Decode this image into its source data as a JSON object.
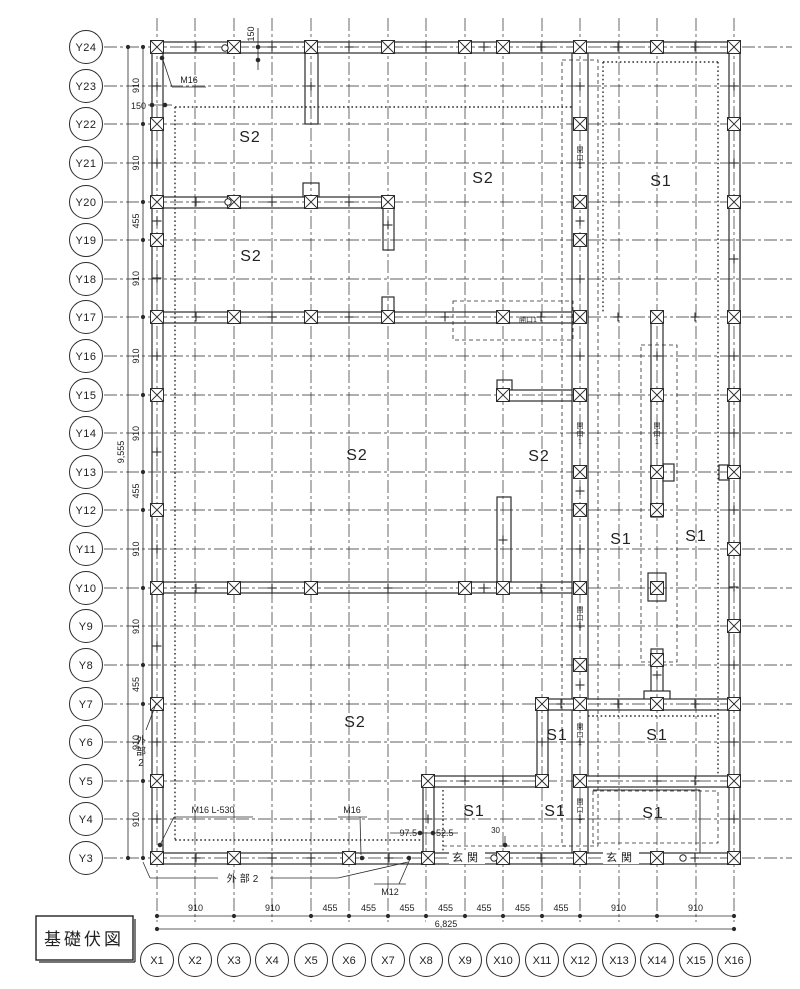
{
  "title_box": {
    "label": "基礎伏図"
  },
  "line_color": "#2b2b2b",
  "grid": {
    "x_axes": [
      {
        "label": "X1",
        "x": 157
      },
      {
        "label": "X2",
        "x": 195
      },
      {
        "label": "X3",
        "x": 234
      },
      {
        "label": "X4",
        "x": 272
      },
      {
        "label": "X5",
        "x": 311
      },
      {
        "label": "X6",
        "x": 349
      },
      {
        "label": "X7",
        "x": 388
      },
      {
        "label": "X8",
        "x": 426
      },
      {
        "label": "X9",
        "x": 465
      },
      {
        "label": "X10",
        "x": 503
      },
      {
        "label": "X11",
        "x": 542
      },
      {
        "label": "X12",
        "x": 580
      },
      {
        "label": "X13",
        "x": 619
      },
      {
        "label": "X14",
        "x": 657
      },
      {
        "label": "X15",
        "x": 696
      },
      {
        "label": "X16",
        "x": 734
      }
    ],
    "y_axes": [
      {
        "label": "Y24",
        "y": 47
      },
      {
        "label": "Y23",
        "y": 86
      },
      {
        "label": "Y22",
        "y": 124
      },
      {
        "label": "Y21",
        "y": 163
      },
      {
        "label": "Y20",
        "y": 202
      },
      {
        "label": "Y19",
        "y": 240
      },
      {
        "label": "Y18",
        "y": 279
      },
      {
        "label": "Y17",
        "y": 317
      },
      {
        "label": "Y16",
        "y": 356
      },
      {
        "label": "Y15",
        "y": 395
      },
      {
        "label": "Y14",
        "y": 433
      },
      {
        "label": "Y13",
        "y": 472
      },
      {
        "label": "Y12",
        "y": 510
      },
      {
        "label": "Y11",
        "y": 549
      },
      {
        "label": "Y10",
        "y": 588
      },
      {
        "label": "Y9",
        "y": 626
      },
      {
        "label": "Y8",
        "y": 665
      },
      {
        "label": "Y7",
        "y": 704
      },
      {
        "label": "Y6",
        "y": 742
      },
      {
        "label": "Y5",
        "y": 781
      },
      {
        "label": "Y4",
        "y": 819
      },
      {
        "label": "Y3",
        "y": 858
      }
    ]
  },
  "dim_left": {
    "total": "9,555",
    "boundaries": [
      47,
      124,
      202,
      240,
      317,
      395,
      472,
      510,
      588,
      665,
      704,
      781,
      858
    ],
    "labels": [
      "910",
      "910",
      "455",
      "910",
      "910",
      "910",
      "455",
      "910",
      "910",
      "455",
      "910",
      "910"
    ]
  },
  "dim_bottom": {
    "total": "6,825",
    "boundaries": [
      157,
      234,
      311,
      349,
      388,
      426,
      465,
      503,
      542,
      580,
      657,
      734
    ],
    "labels": [
      "910",
      "910",
      "455",
      "455",
      "455",
      "455",
      "455",
      "455",
      "455",
      "910",
      "910"
    ]
  },
  "walls": [
    [
      152,
      42,
      588,
      11
    ],
    [
      152,
      42,
      11,
      821
    ],
    [
      152,
      853,
      588,
      11
    ],
    [
      729,
      42,
      11,
      821
    ],
    [
      305,
      53,
      13,
      71
    ],
    [
      303,
      183,
      16,
      15
    ],
    [
      163,
      197,
      231,
      11
    ],
    [
      383,
      208,
      11,
      42
    ],
    [
      382,
      297,
      12,
      16
    ],
    [
      163,
      312,
      425,
      11
    ],
    [
      572,
      53,
      16,
      800
    ],
    [
      497,
      380,
      15,
      11
    ],
    [
      497,
      390,
      75,
      11
    ],
    [
      497,
      497,
      14,
      91
    ],
    [
      163,
      582,
      409,
      11
    ],
    [
      651,
      317,
      12,
      200
    ],
    [
      663,
      464,
      11,
      17
    ],
    [
      719,
      465,
      10,
      15
    ],
    [
      648,
      573,
      18,
      28
    ],
    [
      651,
      649,
      12,
      45
    ],
    [
      644,
      691,
      26,
      12
    ],
    [
      537,
      699,
      203,
      11
    ],
    [
      537,
      699,
      11,
      88
    ],
    [
      423,
      776,
      125,
      11
    ],
    [
      423,
      776,
      11,
      88
    ],
    [
      583,
      776,
      146,
      11
    ]
  ],
  "porch_opening": {
    "rect": [
      614,
      854,
      86,
      9
    ],
    "edges": [
      [
        614,
        853,
        700,
        853
      ],
      [
        614,
        864,
        700,
        864
      ]
    ]
  },
  "porch_lines": [
    [
      593,
      790,
      700,
      790
    ],
    [
      700,
      790,
      700,
      853
    ]
  ],
  "dotted_lines": [
    [
      175,
      107,
      175,
      840
    ],
    [
      175,
      107,
      572,
      107
    ],
    [
      175,
      840,
      423,
      840
    ],
    [
      603,
      62,
      603,
      312
    ],
    [
      718,
      62,
      718,
      776
    ],
    [
      603,
      62,
      718,
      62
    ],
    [
      588,
      716,
      718,
      716
    ],
    [
      443,
      790,
      443,
      853
    ]
  ],
  "dashed_rects": [
    [
      562,
      60,
      36,
      786
    ],
    [
      641,
      345,
      36,
      317
    ],
    [
      453,
      301,
      120,
      39
    ],
    [
      593,
      791,
      125,
      52
    ]
  ],
  "dashed_lines": [
    [
      443,
      846,
      570,
      846
    ]
  ],
  "bolts": [
    [
      157,
      47
    ],
    [
      234,
      47
    ],
    [
      311,
      47
    ],
    [
      388,
      47
    ],
    [
      465,
      47
    ],
    [
      503,
      47
    ],
    [
      580,
      47
    ],
    [
      657,
      47
    ],
    [
      734,
      47
    ],
    [
      157,
      124
    ],
    [
      157,
      202
    ],
    [
      157,
      240
    ],
    [
      157,
      317
    ],
    [
      157,
      395
    ],
    [
      157,
      510
    ],
    [
      157,
      588
    ],
    [
      157,
      704
    ],
    [
      157,
      781
    ],
    [
      157,
      858
    ],
    [
      734,
      124
    ],
    [
      734,
      202
    ],
    [
      734,
      317
    ],
    [
      734,
      395
    ],
    [
      734,
      472
    ],
    [
      734,
      549
    ],
    [
      734,
      626
    ],
    [
      734,
      704
    ],
    [
      734,
      781
    ],
    [
      734,
      858
    ],
    [
      234,
      858
    ],
    [
      349,
      858
    ],
    [
      428,
      858
    ],
    [
      503,
      858
    ],
    [
      580,
      858
    ],
    [
      657,
      858
    ],
    [
      234,
      202
    ],
    [
      311,
      202
    ],
    [
      388,
      202
    ],
    [
      234,
      317
    ],
    [
      311,
      317
    ],
    [
      388,
      317
    ],
    [
      503,
      317
    ],
    [
      580,
      317
    ],
    [
      657,
      317
    ],
    [
      580,
      124
    ],
    [
      580,
      202
    ],
    [
      580,
      240
    ],
    [
      580,
      395
    ],
    [
      580,
      472
    ],
    [
      580,
      510
    ],
    [
      580,
      588
    ],
    [
      580,
      665
    ],
    [
      580,
      704
    ],
    [
      580,
      781
    ],
    [
      657,
      395
    ],
    [
      657,
      472
    ],
    [
      657,
      510
    ],
    [
      657,
      588
    ],
    [
      657,
      660
    ],
    [
      657,
      704
    ],
    [
      503,
      395
    ],
    [
      234,
      588
    ],
    [
      311,
      588
    ],
    [
      465,
      588
    ],
    [
      503,
      588
    ],
    [
      542,
      704
    ],
    [
      542,
      781
    ],
    [
      428,
      781
    ]
  ],
  "plus_marks": [
    [
      196,
      47
    ],
    [
      272,
      47
    ],
    [
      349,
      47
    ],
    [
      426,
      47
    ],
    [
      484,
      47
    ],
    [
      541,
      47
    ],
    [
      618,
      47
    ],
    [
      695,
      47
    ],
    [
      157,
      86
    ],
    [
      157,
      163
    ],
    [
      157,
      221
    ],
    [
      157,
      278
    ],
    [
      157,
      356
    ],
    [
      157,
      452
    ],
    [
      157,
      549
    ],
    [
      157,
      646
    ],
    [
      157,
      742
    ],
    [
      157,
      819
    ],
    [
      734,
      86
    ],
    [
      734,
      163
    ],
    [
      734,
      259
    ],
    [
      734,
      356
    ],
    [
      734,
      433
    ],
    [
      734,
      510
    ],
    [
      734,
      587
    ],
    [
      734,
      665
    ],
    [
      734,
      742
    ],
    [
      734,
      819
    ],
    [
      196,
      858
    ],
    [
      272,
      858
    ],
    [
      311,
      858
    ],
    [
      389,
      858
    ],
    [
      465,
      858
    ],
    [
      541,
      858
    ],
    [
      618,
      858
    ],
    [
      695,
      858
    ],
    [
      580,
      86
    ],
    [
      580,
      163
    ],
    [
      580,
      221
    ],
    [
      580,
      279
    ],
    [
      580,
      356
    ],
    [
      580,
      433
    ],
    [
      580,
      491
    ],
    [
      580,
      549
    ],
    [
      580,
      626
    ],
    [
      580,
      685
    ],
    [
      580,
      742
    ],
    [
      580,
      819
    ],
    [
      196,
      317
    ],
    [
      272,
      317
    ],
    [
      349,
      317
    ],
    [
      445,
      317
    ],
    [
      541,
      317
    ],
    [
      618,
      317
    ],
    [
      695,
      317
    ],
    [
      196,
      202
    ],
    [
      272,
      202
    ],
    [
      349,
      202
    ],
    [
      196,
      588
    ],
    [
      272,
      588
    ],
    [
      388,
      588
    ],
    [
      484,
      588
    ],
    [
      541,
      588
    ],
    [
      561,
      704
    ],
    [
      618,
      704
    ],
    [
      695,
      704
    ],
    [
      657,
      356
    ],
    [
      657,
      433
    ],
    [
      657,
      675
    ],
    [
      542,
      742
    ],
    [
      465,
      781
    ],
    [
      503,
      781
    ],
    [
      657,
      781
    ],
    [
      695,
      781
    ],
    [
      428,
      819
    ],
    [
      311,
      86
    ],
    [
      503,
      540
    ],
    [
      388,
      225
    ]
  ],
  "dots": [
    [
      162,
      58
    ],
    [
      160,
      845
    ],
    [
      362,
      858
    ],
    [
      409,
      858
    ],
    [
      505,
      845
    ],
    [
      152,
      105
    ],
    [
      165,
      105
    ],
    [
      258,
      47
    ],
    [
      258,
      60
    ],
    [
      420,
      833
    ],
    [
      433,
      833
    ]
  ],
  "rings": [
    [
      225,
      48
    ],
    [
      228,
      202
    ],
    [
      494,
      858
    ],
    [
      683,
      858
    ]
  ],
  "openings": {
    "text": "開口1",
    "vertical": [
      [
        580,
        160
      ],
      [
        580,
        436
      ],
      [
        580,
        620
      ],
      [
        580,
        737
      ],
      [
        580,
        812
      ],
      [
        657,
        436
      ]
    ],
    "horizontal": [
      [
        528,
        322
      ]
    ]
  },
  "region_labels": [
    {
      "text": "S2",
      "x": 250,
      "y": 142
    },
    {
      "text": "S2",
      "x": 483,
      "y": 183
    },
    {
      "text": "S1",
      "x": 661,
      "y": 186
    },
    {
      "text": "S2",
      "x": 251,
      "y": 261
    },
    {
      "text": "S2",
      "x": 357,
      "y": 460
    },
    {
      "text": "S2",
      "x": 539,
      "y": 461
    },
    {
      "text": "S1",
      "x": 621,
      "y": 544
    },
    {
      "text": "S1",
      "x": 696,
      "y": 541
    },
    {
      "text": "S2",
      "x": 355,
      "y": 727
    },
    {
      "text": "S1",
      "x": 557,
      "y": 740
    },
    {
      "text": "S1",
      "x": 657,
      "y": 740
    },
    {
      "text": "S1",
      "x": 474,
      "y": 816
    },
    {
      "text": "S1",
      "x": 555,
      "y": 816
    },
    {
      "text": "S1",
      "x": 653,
      "y": 818
    }
  ],
  "notes": [
    {
      "t": "M16",
      "x": 189,
      "y": 83,
      "fs": 9
    },
    {
      "t": "M16 L-530",
      "x": 213,
      "y": 813,
      "fs": 9
    },
    {
      "t": "M16",
      "x": 352,
      "y": 813,
      "fs": 9
    },
    {
      "t": "M12",
      "x": 390,
      "y": 895,
      "fs": 9
    },
    {
      "t": "外部2",
      "x": 244,
      "y": 882,
      "fs": 10,
      "ls": 3
    },
    {
      "t": "外部2",
      "x": 141,
      "y": 755,
      "fs": 10,
      "vert": true
    },
    {
      "t": "玄関",
      "x": 467,
      "y": 861,
      "fs": 11,
      "bg": true,
      "ls": 4
    },
    {
      "t": "玄関",
      "x": 621,
      "y": 861,
      "fs": 11,
      "bg": true,
      "ls": 4
    },
    {
      "t": "150",
      "x": 146,
      "y": 109,
      "fs": 9,
      "anchor": "end"
    },
    {
      "t": "150",
      "x": 254,
      "y": 34,
      "fs": 9,
      "rot": -90
    },
    {
      "t": "97.5",
      "x": 417,
      "y": 836,
      "fs": 9,
      "anchor": "end"
    },
    {
      "t": "52.5",
      "x": 436,
      "y": 836,
      "fs": 9,
      "anchor": "start"
    },
    {
      "t": "30",
      "x": 500,
      "y": 833,
      "fs": 8,
      "anchor": "end"
    }
  ],
  "note_lines": [
    [
      172,
      87,
      206,
      87
    ],
    [
      172,
      87,
      163,
      60
    ],
    [
      174,
      817,
      253,
      817
    ],
    [
      174,
      817,
      159,
      847
    ],
    [
      338,
      817,
      367,
      817
    ],
    [
      360,
      817,
      361,
      855
    ],
    [
      374,
      884,
      406,
      884
    ],
    [
      399,
      884,
      410,
      859
    ],
    [
      150,
      878,
      218,
      878
    ],
    [
      270,
      878,
      338,
      878
    ],
    [
      338,
      878,
      408,
      862
    ],
    [
      146,
      730,
      156,
      704
    ],
    [
      150,
      878,
      143,
      862
    ],
    [
      148,
      105,
      172,
      105
    ],
    [
      258,
      28,
      258,
      70
    ],
    [
      390,
      833,
      458,
      833
    ],
    [
      505,
      836,
      505,
      847
    ]
  ]
}
